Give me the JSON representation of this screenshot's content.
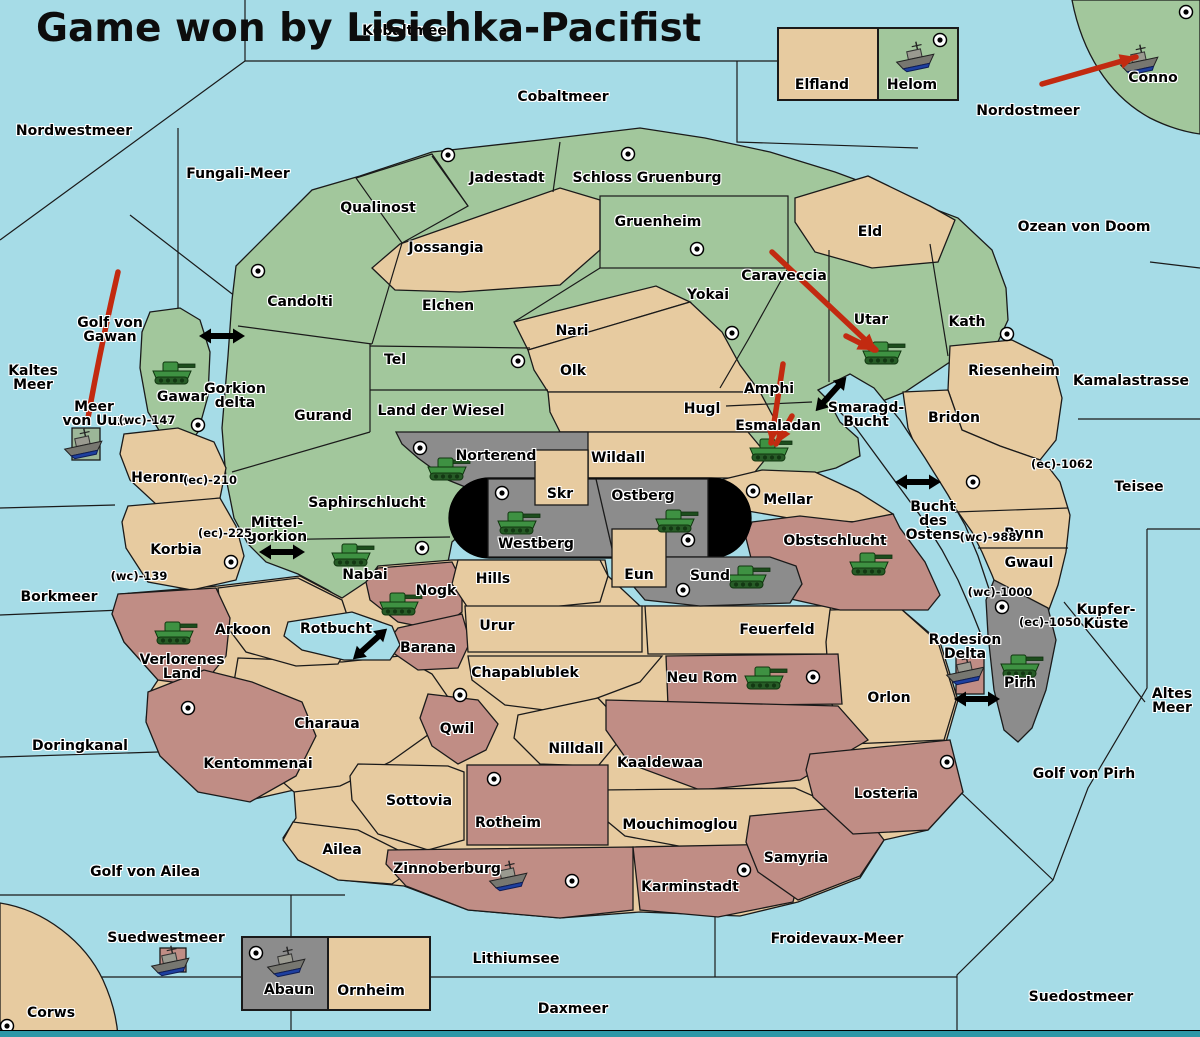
{
  "title": "Game won by Lisichka-Pacifist",
  "colors": {
    "sea": "#a6dce7",
    "green": "#a2c79c",
    "tan": "#e7cba0",
    "pink": "#c08d85",
    "gray": "#8c8c8c",
    "black_zone": "#000000",
    "arrow_red": "#c22a10",
    "border": "#1a1a1a",
    "map_edge": "#2d97a7",
    "army_green": "#3e9142",
    "fleet_gray": "#777770",
    "fleet_keel_blue": "#1d3fa0"
  },
  "sea_labels": [
    {
      "name": "Nordwestmeer",
      "x": 74,
      "y": 131
    },
    {
      "name": "Kobaltmeer",
      "x": 408,
      "y": 31
    },
    {
      "name": "Cobaltmeer",
      "x": 563,
      "y": 97
    },
    {
      "name": "Nordostmeer",
      "x": 1028,
      "y": 111
    },
    {
      "name": "Fungali-Meer",
      "x": 238,
      "y": 174
    },
    {
      "name": "Ozean von Doom",
      "x": 1084,
      "y": 227
    },
    {
      "name": "Kamalastrasse",
      "x": 1131,
      "y": 381
    },
    {
      "name": "Kaltes Meer",
      "x": 33,
      "y": 378,
      "lines": [
        "Kaltes",
        "Meer"
      ]
    },
    {
      "name": "Golf von Gawan",
      "x": 110,
      "y": 330,
      "lines": [
        "Golf von",
        "Gawan"
      ]
    },
    {
      "name": "Meer von Uuz",
      "x": 94,
      "y": 414,
      "lines": [
        "Meer",
        "von Uuz"
      ]
    },
    {
      "name": "Gorkion delta",
      "x": 235,
      "y": 396,
      "lines": [
        "Gorkion",
        "delta"
      ]
    },
    {
      "name": "Mittel-gorkion",
      "x": 277,
      "y": 530,
      "lines": [
        "Mittel-",
        "gorkion"
      ]
    },
    {
      "name": "Borkmeer",
      "x": 59,
      "y": 597
    },
    {
      "name": "Smaragd-Bucht",
      "x": 866,
      "y": 415,
      "lines": [
        "Smaragd-",
        "Bucht"
      ]
    },
    {
      "name": "Bucht des Ostens",
      "x": 933,
      "y": 521,
      "lines": [
        "Bucht",
        "des",
        "Ostens"
      ]
    },
    {
      "name": "Teisee",
      "x": 1139,
      "y": 487
    },
    {
      "name": "Kupfer-Küste",
      "x": 1106,
      "y": 617,
      "lines": [
        "Kupfer-",
        "Küste"
      ]
    },
    {
      "name": "Rotbucht",
      "x": 336,
      "y": 629
    },
    {
      "name": "Altes Meer",
      "x": 1172,
      "y": 701,
      "lines": [
        "Altes",
        "Meer"
      ]
    },
    {
      "name": "Golf von Pirh",
      "x": 1084,
      "y": 774
    },
    {
      "name": "Doringkanal",
      "x": 80,
      "y": 746
    },
    {
      "name": "Golf von Ailea",
      "x": 145,
      "y": 872
    },
    {
      "name": "Suedwestmeer",
      "x": 166,
      "y": 938
    },
    {
      "name": "Lithiumsee",
      "x": 516,
      "y": 959
    },
    {
      "name": "Froidevaux-Meer",
      "x": 837,
      "y": 939
    },
    {
      "name": "Daxmeer",
      "x": 573,
      "y": 1009
    },
    {
      "name": "Suedostmeer",
      "x": 1081,
      "y": 997
    }
  ],
  "territory_labels": [
    {
      "name": "Jadestadt",
      "x": 507,
      "y": 178
    },
    {
      "name": "Schloss Gruenburg",
      "x": 647,
      "y": 178
    },
    {
      "name": "Qualinost",
      "x": 378,
      "y": 208
    },
    {
      "name": "Jossangia",
      "x": 446,
      "y": 248
    },
    {
      "name": "Gruenheim",
      "x": 658,
      "y": 222
    },
    {
      "name": "Eld",
      "x": 870,
      "y": 232
    },
    {
      "name": "Candolti",
      "x": 300,
      "y": 302
    },
    {
      "name": "Elchen",
      "x": 448,
      "y": 306
    },
    {
      "name": "Caraveccia",
      "x": 784,
      "y": 276
    },
    {
      "name": "Yokai",
      "x": 708,
      "y": 295
    },
    {
      "name": "Nari",
      "x": 572,
      "y": 331
    },
    {
      "name": "Tel",
      "x": 395,
      "y": 360
    },
    {
      "name": "Olk",
      "x": 573,
      "y": 371
    },
    {
      "name": "Gurand",
      "x": 323,
      "y": 416
    },
    {
      "name": "Land der Wiesel",
      "x": 441,
      "y": 411
    },
    {
      "name": "Hugl",
      "x": 702,
      "y": 409
    },
    {
      "name": "Utar",
      "x": 871,
      "y": 320
    },
    {
      "name": "Kath",
      "x": 967,
      "y": 322
    },
    {
      "name": "Riesenheim",
      "x": 1014,
      "y": 371
    },
    {
      "name": "Bridon",
      "x": 954,
      "y": 418
    },
    {
      "name": "Amphi",
      "x": 769,
      "y": 389
    },
    {
      "name": "Esmaladan",
      "x": 778,
      "y": 426
    },
    {
      "name": "Gawar",
      "x": 182,
      "y": 397
    },
    {
      "name": "Heronn",
      "x": 160,
      "y": 478
    },
    {
      "name": "Korbia",
      "x": 176,
      "y": 550
    },
    {
      "name": "Saphirschlucht",
      "x": 367,
      "y": 503
    },
    {
      "name": "Nabai",
      "x": 365,
      "y": 575
    },
    {
      "name": "Norterend",
      "x": 496,
      "y": 456
    },
    {
      "name": "Wildall",
      "x": 618,
      "y": 458
    },
    {
      "name": "Skr",
      "x": 560,
      "y": 494
    },
    {
      "name": "Ostberg",
      "x": 643,
      "y": 496
    },
    {
      "name": "Westberg",
      "x": 536,
      "y": 544
    },
    {
      "name": "Eun",
      "x": 639,
      "y": 575
    },
    {
      "name": "Sund",
      "x": 710,
      "y": 576
    },
    {
      "name": "Mellar",
      "x": 788,
      "y": 500
    },
    {
      "name": "Obstschlucht",
      "x": 835,
      "y": 541
    },
    {
      "name": "Bynn",
      "x": 1024,
      "y": 534
    },
    {
      "name": "Gwaul",
      "x": 1029,
      "y": 563
    },
    {
      "name": "Pirh",
      "x": 1020,
      "y": 683
    },
    {
      "name": "Rodesion Delta",
      "x": 965,
      "y": 647,
      "lines": [
        "Rodesion",
        "Delta"
      ]
    },
    {
      "name": "Hills",
      "x": 493,
      "y": 579
    },
    {
      "name": "Nogk",
      "x": 436,
      "y": 591
    },
    {
      "name": "Barana",
      "x": 428,
      "y": 648
    },
    {
      "name": "Arkoon",
      "x": 243,
      "y": 630
    },
    {
      "name": "Verlorenes Land",
      "x": 182,
      "y": 667,
      "lines": [
        "Verlorenes",
        "Land"
      ]
    },
    {
      "name": "Kentommenai",
      "x": 258,
      "y": 764
    },
    {
      "name": "Charaua",
      "x": 327,
      "y": 724
    },
    {
      "name": "Urur",
      "x": 497,
      "y": 626
    },
    {
      "name": "Feuerfeld",
      "x": 777,
      "y": 630
    },
    {
      "name": "Chapablublek",
      "x": 525,
      "y": 673
    },
    {
      "name": "Neu Rom",
      "x": 702,
      "y": 678
    },
    {
      "name": "Qwil",
      "x": 457,
      "y": 729
    },
    {
      "name": "Nilldall",
      "x": 576,
      "y": 749
    },
    {
      "name": "Kaaldewaa",
      "x": 660,
      "y": 763
    },
    {
      "name": "Mouchimoglou",
      "x": 680,
      "y": 825
    },
    {
      "name": "Rotheim",
      "x": 508,
      "y": 823
    },
    {
      "name": "Sottovia",
      "x": 419,
      "y": 801
    },
    {
      "name": "Ailea",
      "x": 342,
      "y": 850
    },
    {
      "name": "Zinnoberburg",
      "x": 447,
      "y": 869
    },
    {
      "name": "Karminstadt",
      "x": 690,
      "y": 887
    },
    {
      "name": "Samyria",
      "x": 796,
      "y": 858
    },
    {
      "name": "Losteria",
      "x": 886,
      "y": 794
    },
    {
      "name": "Orlon",
      "x": 889,
      "y": 698
    },
    {
      "name": "Conno",
      "x": 1153,
      "y": 78
    },
    {
      "name": "Elfland",
      "x": 822,
      "y": 85
    },
    {
      "name": "Helom",
      "x": 912,
      "y": 85
    },
    {
      "name": "Abaun",
      "x": 289,
      "y": 990
    },
    {
      "name": "Ornheim",
      "x": 371,
      "y": 991
    },
    {
      "name": "Corws",
      "x": 51,
      "y": 1013
    }
  ],
  "coast_markers": [
    {
      "label": "(wc)",
      "x": 147,
      "y": 420
    },
    {
      "label": "(ec)",
      "x": 210,
      "y": 480
    },
    {
      "label": "(ec)",
      "x": 225,
      "y": 533
    },
    {
      "label": "(wc)",
      "x": 139,
      "y": 576
    },
    {
      "label": "(ec)",
      "x": 1062,
      "y": 464
    },
    {
      "label": "(wc)",
      "x": 988,
      "y": 537
    },
    {
      "label": "(wc)",
      "x": 1000,
      "y": 592
    },
    {
      "label": "(ec)",
      "x": 1050,
      "y": 622
    }
  ],
  "supply_centers": [
    {
      "territory": "Conno",
      "x": 1186,
      "y": 12
    },
    {
      "territory": "Helom",
      "x": 940,
      "y": 40
    },
    {
      "territory": "Jadestadt",
      "x": 448,
      "y": 155
    },
    {
      "territory": "Schloss Gruenburg",
      "x": 628,
      "y": 154
    },
    {
      "territory": "Gruenheim",
      "x": 697,
      "y": 249
    },
    {
      "territory": "Candolti",
      "x": 258,
      "y": 271
    },
    {
      "territory": "Yokai",
      "x": 732,
      "y": 333
    },
    {
      "territory": "Kath",
      "x": 1007,
      "y": 334
    },
    {
      "territory": "Tel",
      "x": 518,
      "y": 361
    },
    {
      "territory": "Gawar",
      "x": 198,
      "y": 425
    },
    {
      "territory": "Norterend",
      "x": 420,
      "y": 448
    },
    {
      "territory": "Bridon",
      "x": 973,
      "y": 482
    },
    {
      "territory": "Westberg",
      "x": 502,
      "y": 493
    },
    {
      "territory": "Mellar",
      "x": 753,
      "y": 491
    },
    {
      "territory": "Ostberg",
      "x": 688,
      "y": 540
    },
    {
      "territory": "Nabai",
      "x": 422,
      "y": 548
    },
    {
      "territory": "Korbia",
      "x": 231,
      "y": 562
    },
    {
      "territory": "Sund",
      "x": 683,
      "y": 590
    },
    {
      "territory": "Pirh",
      "x": 1002,
      "y": 607
    },
    {
      "territory": "Qwil",
      "x": 460,
      "y": 695
    },
    {
      "territory": "Kentommenai",
      "x": 188,
      "y": 708
    },
    {
      "territory": "Neu Rom",
      "x": 813,
      "y": 677
    },
    {
      "territory": "Losteria",
      "x": 947,
      "y": 762
    },
    {
      "territory": "Rotheim",
      "x": 494,
      "y": 779
    },
    {
      "territory": "Zinnoberburg",
      "x": 572,
      "y": 881
    },
    {
      "territory": "Karminstadt",
      "x": 744,
      "y": 870
    },
    {
      "territory": "Abaun",
      "x": 256,
      "y": 953
    },
    {
      "territory": "Corws",
      "x": 7,
      "y": 1026
    }
  ],
  "units": [
    {
      "type": "army",
      "territory": "Gawar",
      "x": 172,
      "y": 372
    },
    {
      "type": "army",
      "territory": "Utar",
      "x": 882,
      "y": 352
    },
    {
      "type": "army",
      "territory": "Esmaladan",
      "x": 769,
      "y": 449
    },
    {
      "type": "army",
      "territory": "Norterend",
      "x": 447,
      "y": 468
    },
    {
      "type": "army",
      "territory": "Westberg",
      "x": 517,
      "y": 522
    },
    {
      "type": "army",
      "territory": "Ostberg",
      "x": 675,
      "y": 520
    },
    {
      "type": "army",
      "territory": "Sund",
      "x": 747,
      "y": 576
    },
    {
      "type": "army",
      "territory": "Nabai",
      "x": 351,
      "y": 554
    },
    {
      "type": "army",
      "territory": "Nogk",
      "x": 399,
      "y": 603
    },
    {
      "type": "army",
      "territory": "Verlorenes Land",
      "x": 174,
      "y": 632
    },
    {
      "type": "army",
      "territory": "Obstschlucht",
      "x": 869,
      "y": 563
    },
    {
      "type": "army",
      "territory": "Neu Rom",
      "x": 764,
      "y": 677
    },
    {
      "type": "army",
      "territory": "Pirh",
      "x": 1020,
      "y": 665
    },
    {
      "type": "fleet",
      "territory": "Helom",
      "x": 916,
      "y": 57
    },
    {
      "type": "fleet",
      "territory": "Conno",
      "x": 1140,
      "y": 60
    },
    {
      "type": "fleet",
      "territory": "Meer von Uuz",
      "x": 84,
      "y": 444
    },
    {
      "type": "fleet",
      "territory": "Rodesion Delta",
      "x": 966,
      "y": 670
    },
    {
      "type": "fleet",
      "territory": "Zinnoberburg",
      "x": 509,
      "y": 876
    },
    {
      "type": "fleet",
      "territory": "Suedwestmeer",
      "x": 171,
      "y": 961
    },
    {
      "type": "fleet",
      "territory": "Abaun",
      "x": 287,
      "y": 962
    }
  ],
  "move_arrows": [
    {
      "x1": 1042,
      "y1": 84,
      "x2": 1136,
      "y2": 57
    },
    {
      "x1": 118,
      "y1": 272,
      "cx": 100,
      "cy": 350,
      "x2": 88,
      "y2": 418
    },
    {
      "x1": 772,
      "y1": 252,
      "x2": 876,
      "y2": 350
    },
    {
      "x1": 846,
      "y1": 336,
      "x2": 874,
      "y2": 350
    },
    {
      "x1": 783,
      "y1": 364,
      "x2": 771,
      "y2": 443
    },
    {
      "x1": 792,
      "y1": 416,
      "x2": 776,
      "y2": 444
    }
  ],
  "strait_arrows": [
    {
      "x": 222,
      "y": 336,
      "angle": 0
    },
    {
      "x": 282,
      "y": 552,
      "angle": 0
    },
    {
      "x": 831,
      "y": 394,
      "angle": -48
    },
    {
      "x": 918,
      "y": 482,
      "angle": 0
    },
    {
      "x": 370,
      "y": 644,
      "angle": -42
    },
    {
      "x": 977,
      "y": 699,
      "angle": 0
    }
  ]
}
